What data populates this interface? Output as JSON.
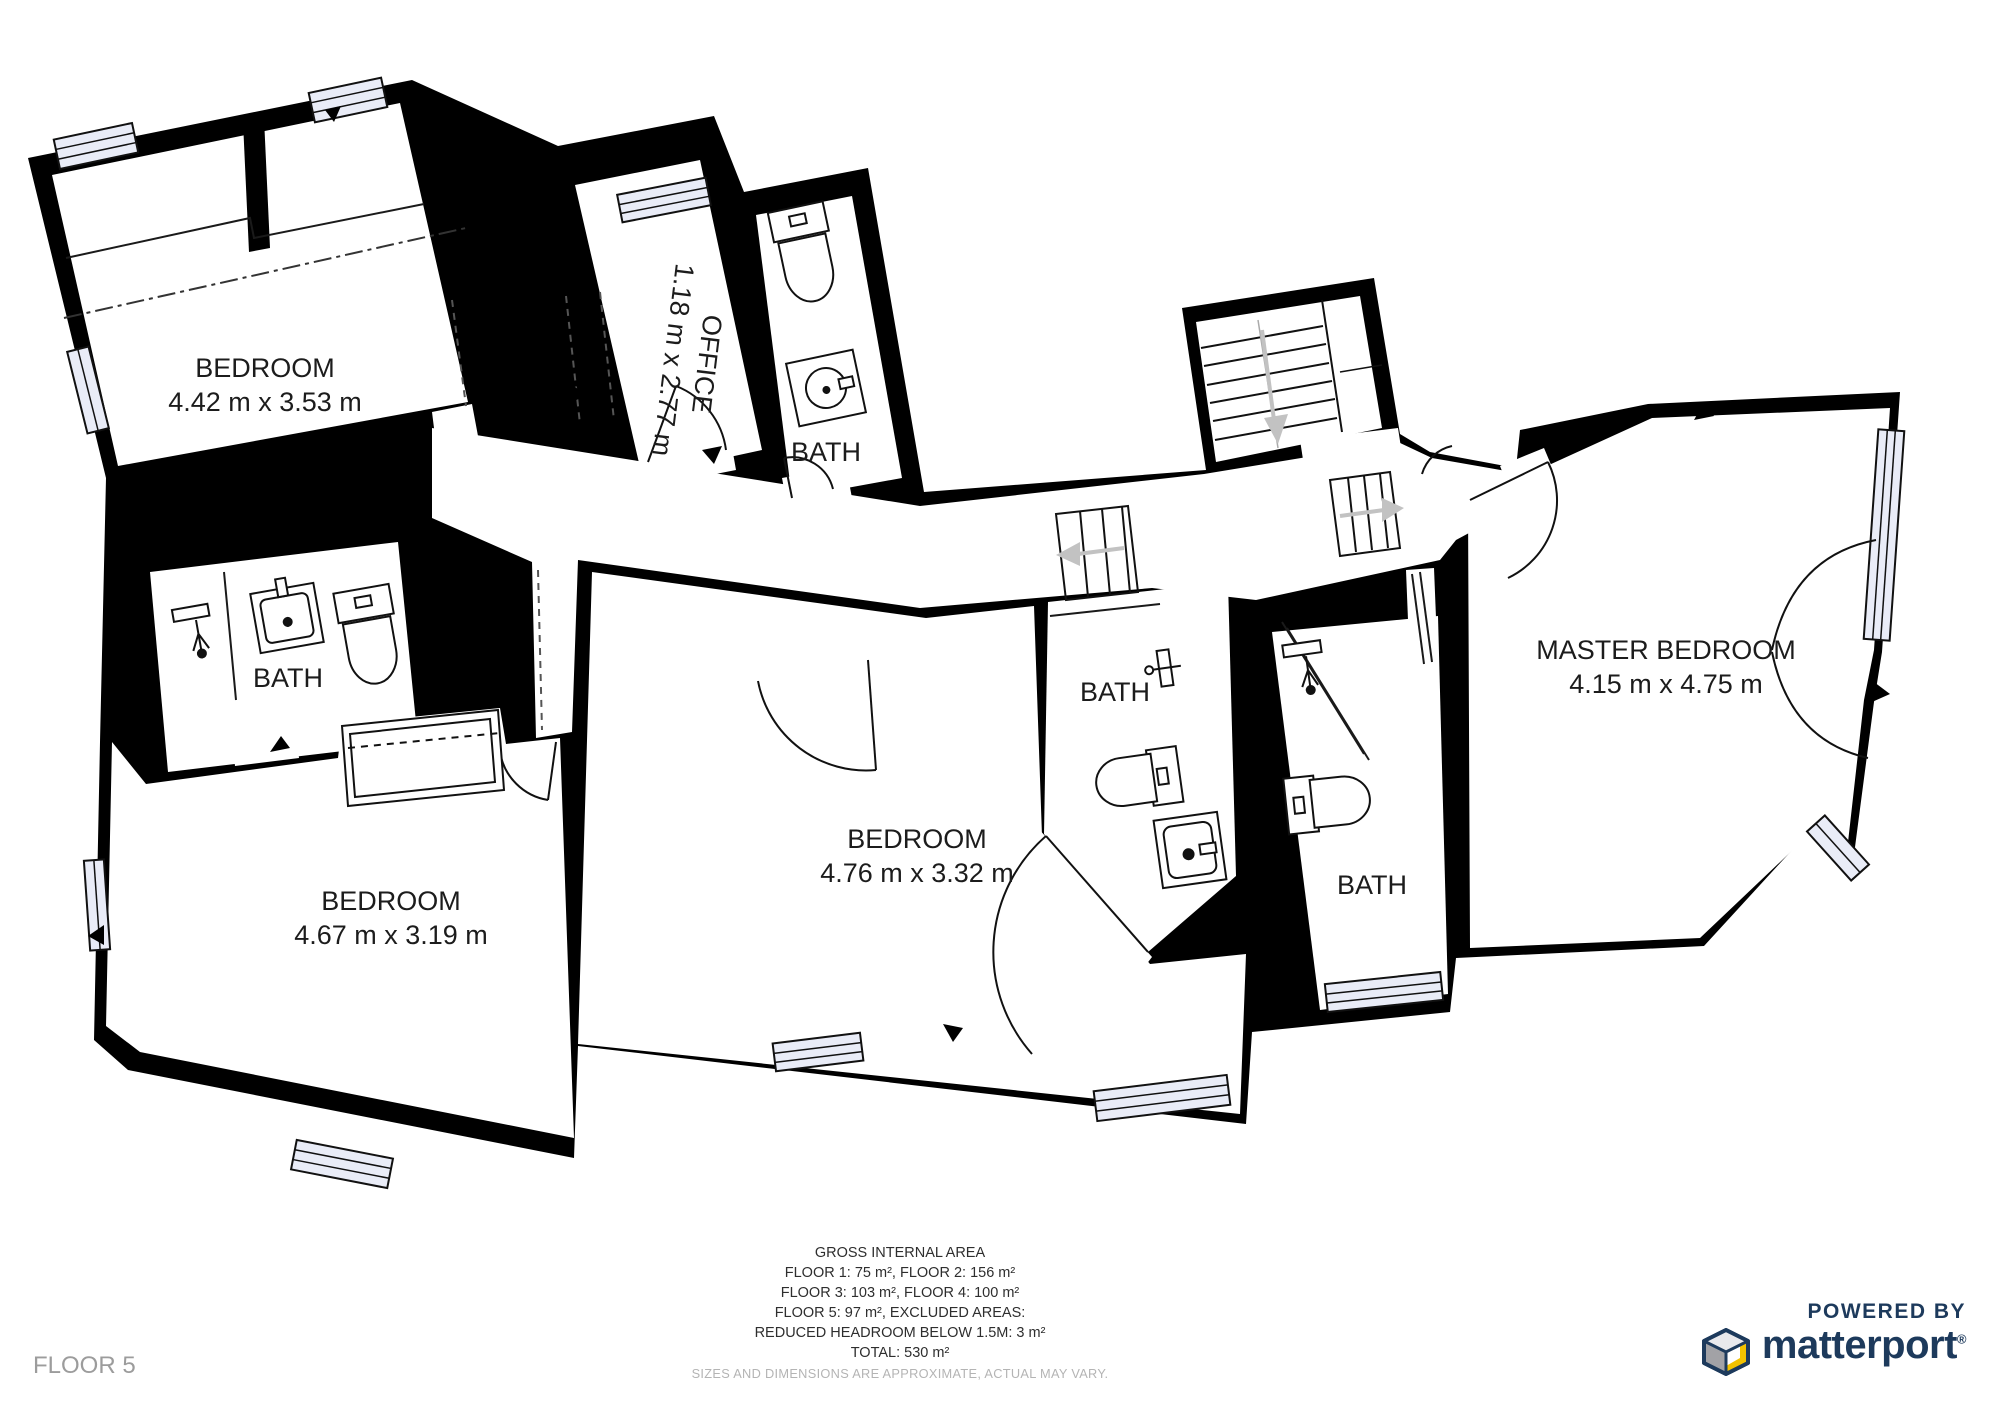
{
  "floor": {
    "label": "FLOOR 5"
  },
  "rooms": {
    "bedroom_tl": {
      "name": "BEDROOM",
      "dims": "4.42 m x 3.53 m"
    },
    "office": {
      "name": "OFFICE",
      "dims": "1.18 m x 2.77 m"
    },
    "bath_top": {
      "name": "BATH"
    },
    "bath_left": {
      "name": "BATH"
    },
    "bedroom_bl": {
      "name": "BEDROOM",
      "dims": "4.67 m x 3.19 m"
    },
    "bedroom_mid": {
      "name": "BEDROOM",
      "dims": "4.76 m x 3.32 m"
    },
    "bath_mid": {
      "name": "BATH"
    },
    "bath_right": {
      "name": "BATH"
    },
    "master": {
      "name": "MASTER BEDROOM",
      "dims": "4.15 m x 4.75 m"
    }
  },
  "area_summary": {
    "title": "GROSS INTERNAL AREA",
    "line1": "FLOOR 1: 75 m², FLOOR 2: 156 m²",
    "line2": "FLOOR 3: 103 m², FLOOR 4: 100 m²",
    "line3": "FLOOR 5: 97 m², EXCLUDED AREAS:",
    "line4": "REDUCED HEADROOM BELOW 1.5M: 3 m²",
    "line5": "TOTAL: 530 m²",
    "disclaimer": "SIZES AND DIMENSIONS ARE APPROXIMATE, ACTUAL MAY VARY."
  },
  "branding": {
    "powered_by": "POWERED BY",
    "brand": "matterport",
    "registered": "®"
  },
  "colors": {
    "wall": "#000000",
    "window_fill": "#e9ecf7",
    "brand_navy": "#1d3a5c",
    "brand_yellow": "#f2c200",
    "muted_text": "#9c9c9c"
  }
}
